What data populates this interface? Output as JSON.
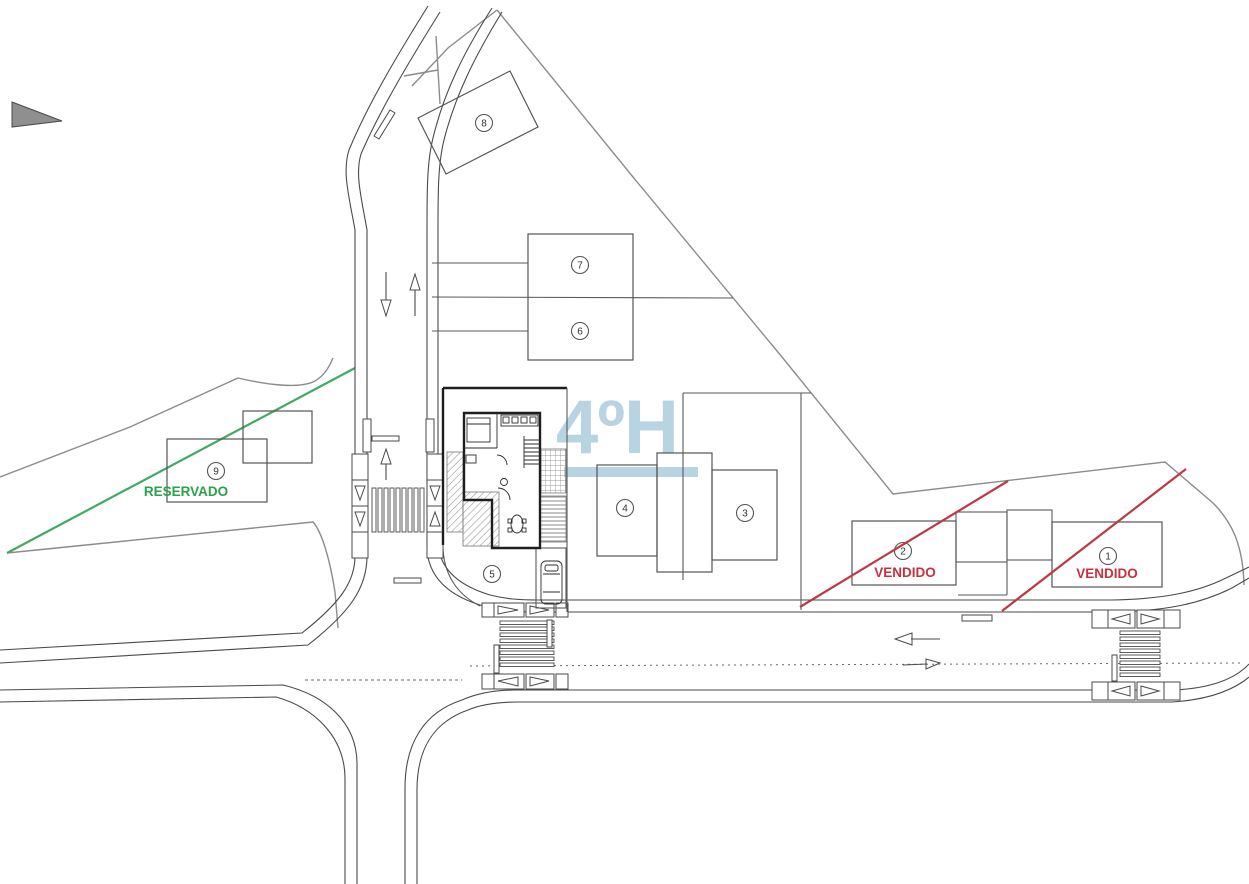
{
  "site_plan": {
    "watermark": {
      "text": "4ºH"
    },
    "labels": {
      "sold": "VENDIDO",
      "reserved": "RESERVADO"
    },
    "colors": {
      "sold_text": "#c5313e",
      "sold_line": "#bd3a45",
      "reserved_text": "#27a348",
      "reserved_line": "#44a865",
      "watermark": "#b8d3e2",
      "ink": "#4a4a4a"
    },
    "lots": [
      {
        "number": "1",
        "status": "VENDIDO"
      },
      {
        "number": "2",
        "status": "VENDIDO"
      },
      {
        "number": "3",
        "status": ""
      },
      {
        "number": "4",
        "status": ""
      },
      {
        "number": "5",
        "status": ""
      },
      {
        "number": "6",
        "status": ""
      },
      {
        "number": "7",
        "status": ""
      },
      {
        "number": "8",
        "status": ""
      },
      {
        "number": "9",
        "status": "RESERVADO"
      }
    ]
  }
}
